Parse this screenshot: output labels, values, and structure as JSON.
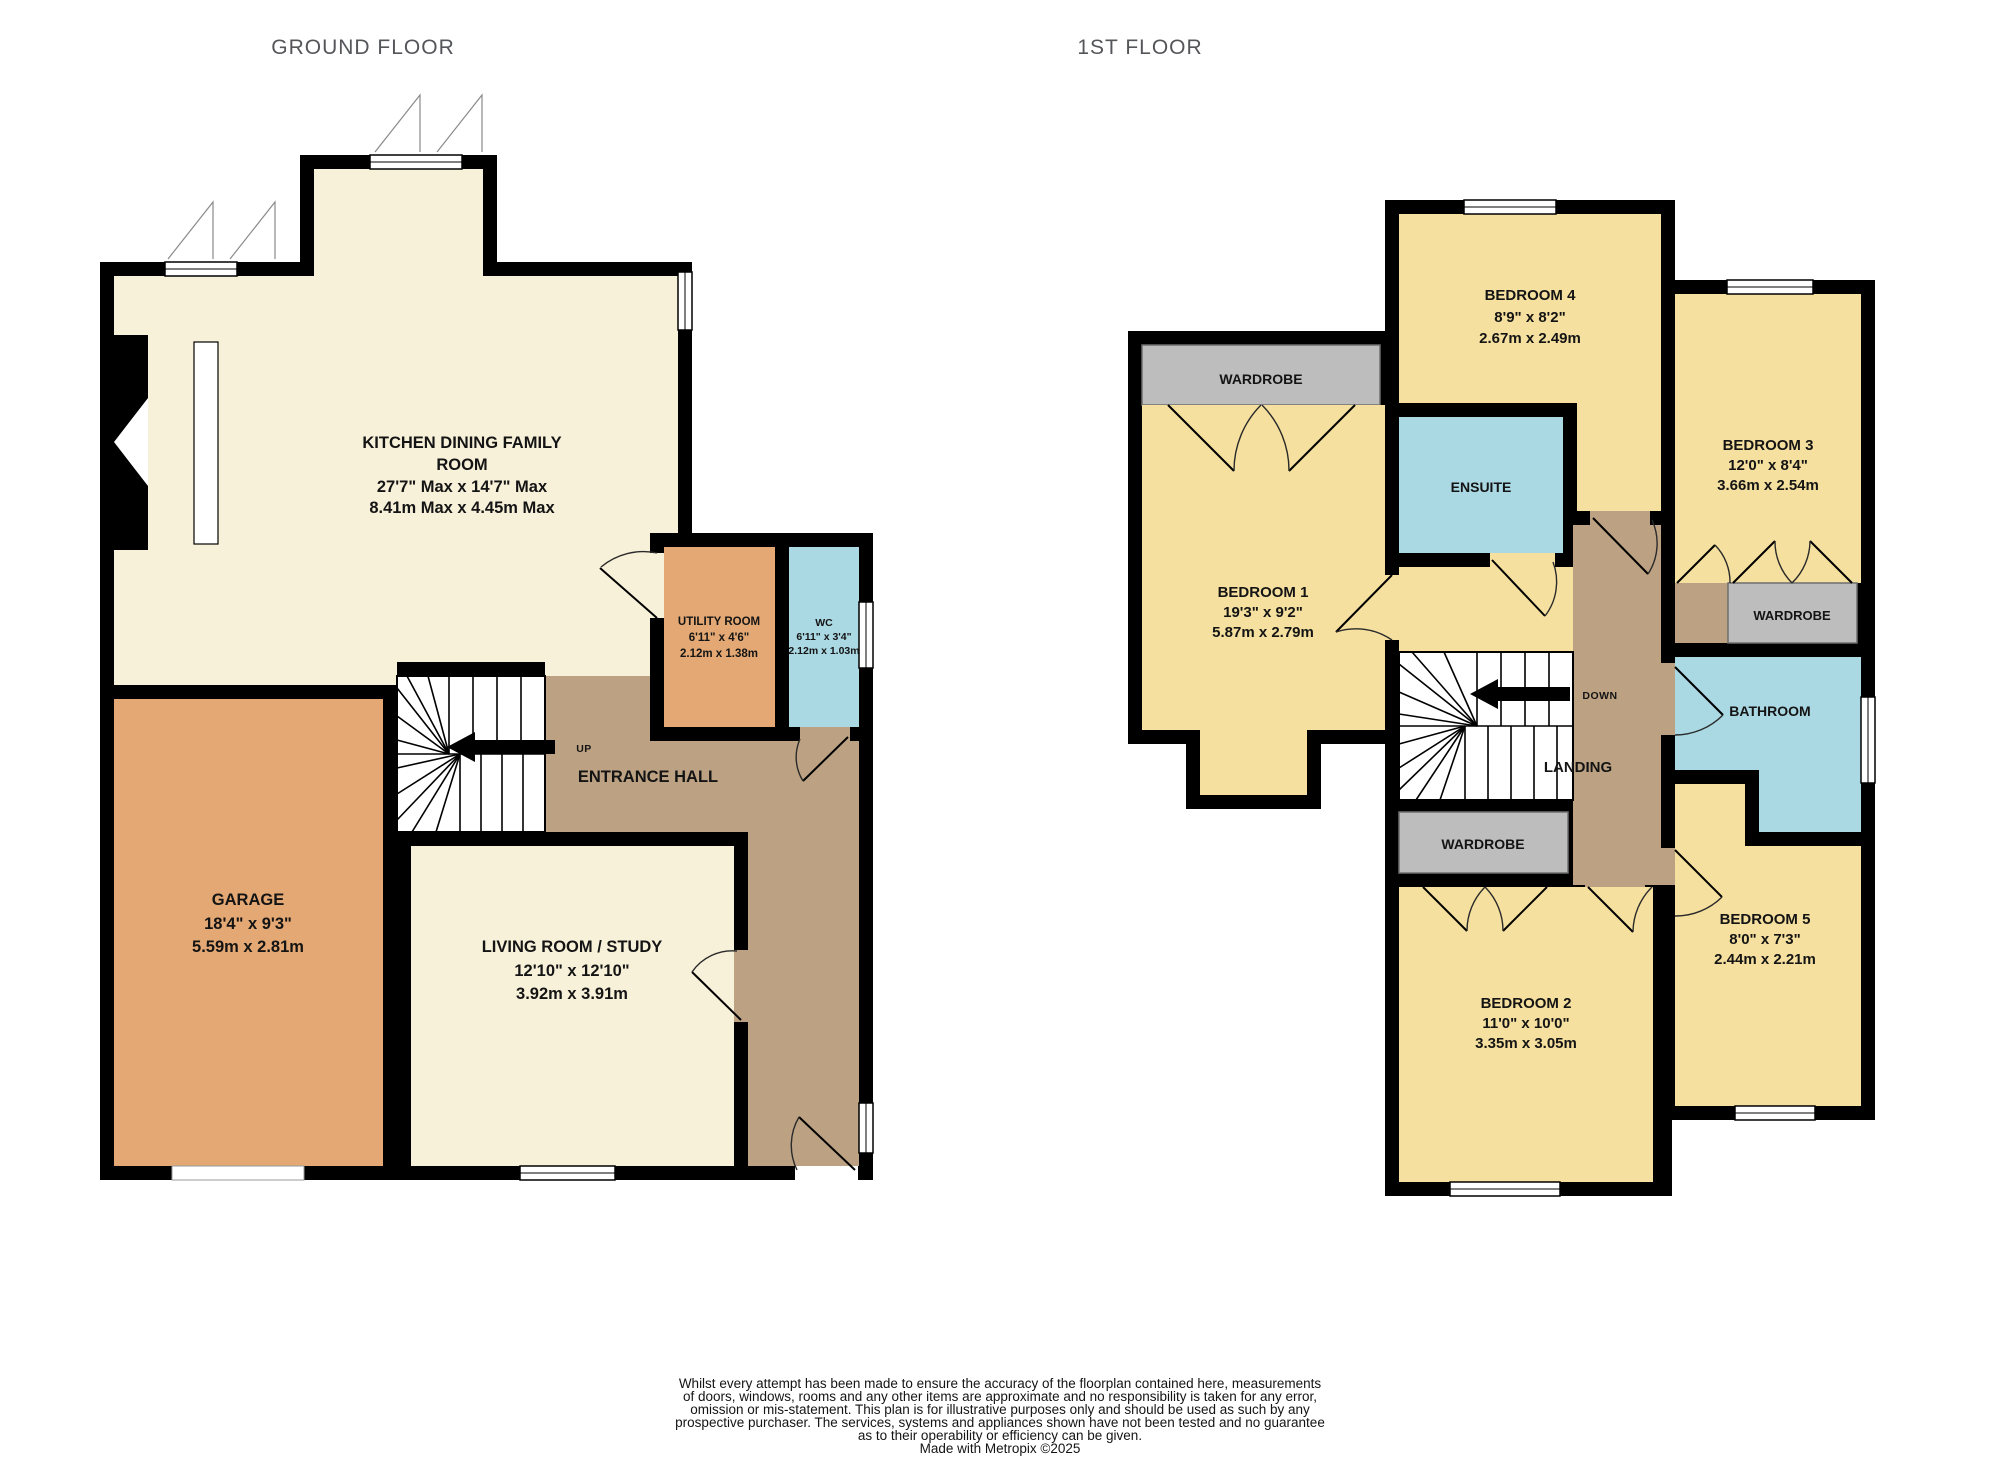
{
  "header": {
    "ground_title": "GROUND FLOOR",
    "first_title": "1ST FLOOR"
  },
  "colors": {
    "wall": "#000000",
    "cream": "#F8F1D9",
    "yellow": "#F5E09F",
    "orange": "#E3A873",
    "taupe": "#BCA283",
    "blue": "#AAD8E3",
    "gray": "#BDBDBD",
    "title": "#55565A"
  },
  "ground": {
    "kitchen_l1": "KITCHEN DINING FAMILY",
    "kitchen_l2": "ROOM",
    "kitchen_l3": "27'7\" Max x 14'7\" Max",
    "kitchen_l4": "8.41m Max x 4.45m Max",
    "garage_l1": "GARAGE",
    "garage_l2": "18'4\"  x 9'3\"",
    "garage_l3": "5.59m  x 2.81m",
    "living_l1": "LIVING ROOM / STUDY",
    "living_l2": "12'10\"  x 12'10\"",
    "living_l3": "3.92m  x 3.91m",
    "utility_l1": "UTILITY ROOM",
    "utility_l2": "6'11\"  x 4'6\"",
    "utility_l3": "2.12m  x 1.38m",
    "wc_l1": "WC",
    "wc_l2": "6'11\"  x 3'4\"",
    "wc_l3": "2.12m  x 1.03m",
    "hall": "ENTRANCE HALL",
    "up": "UP"
  },
  "first": {
    "bedroom1_l1": "BEDROOM 1",
    "bedroom1_l2": "19'3\"  x 9'2\"",
    "bedroom1_l3": "5.87m  x 2.79m",
    "bedroom2_l1": "BEDROOM 2",
    "bedroom2_l2": "11'0\"  x 10'0\"",
    "bedroom2_l3": "3.35m  x 3.05m",
    "bedroom3_l1": "BEDROOM 3",
    "bedroom3_l2": "12'0\"  x 8'4\"",
    "bedroom3_l3": "3.66m  x 2.54m",
    "bedroom4_l1": "BEDROOM 4",
    "bedroom4_l2": "8'9\"  x 8'2\"",
    "bedroom4_l3": "2.67m  x 2.49m",
    "bedroom5_l1": "BEDROOM 5",
    "bedroom5_l2": "8'0\"  x 7'3\"",
    "bedroom5_l3": "2.44m  x 2.21m",
    "ensuite": "ENSUITE",
    "bathroom": "BATHROOM",
    "landing": "LANDING",
    "down": "DOWN",
    "wardrobe1": "WARDROBE",
    "wardrobe2": "WARDROBE",
    "wardrobe3": "WARDROBE"
  },
  "footer": {
    "lines": [
      "Whilst every attempt has been made to ensure the accuracy of the floorplan contained here, measurements",
      "of doors, windows, rooms and any other items are approximate and no responsibility is taken for any error,",
      "omission or mis-statement. This plan is for illustrative purposes only and should be used as such by any",
      "prospective purchaser. The services, systems and appliances shown have not been tested and no guarantee",
      "as to their operability or efficiency can be given."
    ],
    "credit": "Made with Metropix ©2025"
  }
}
